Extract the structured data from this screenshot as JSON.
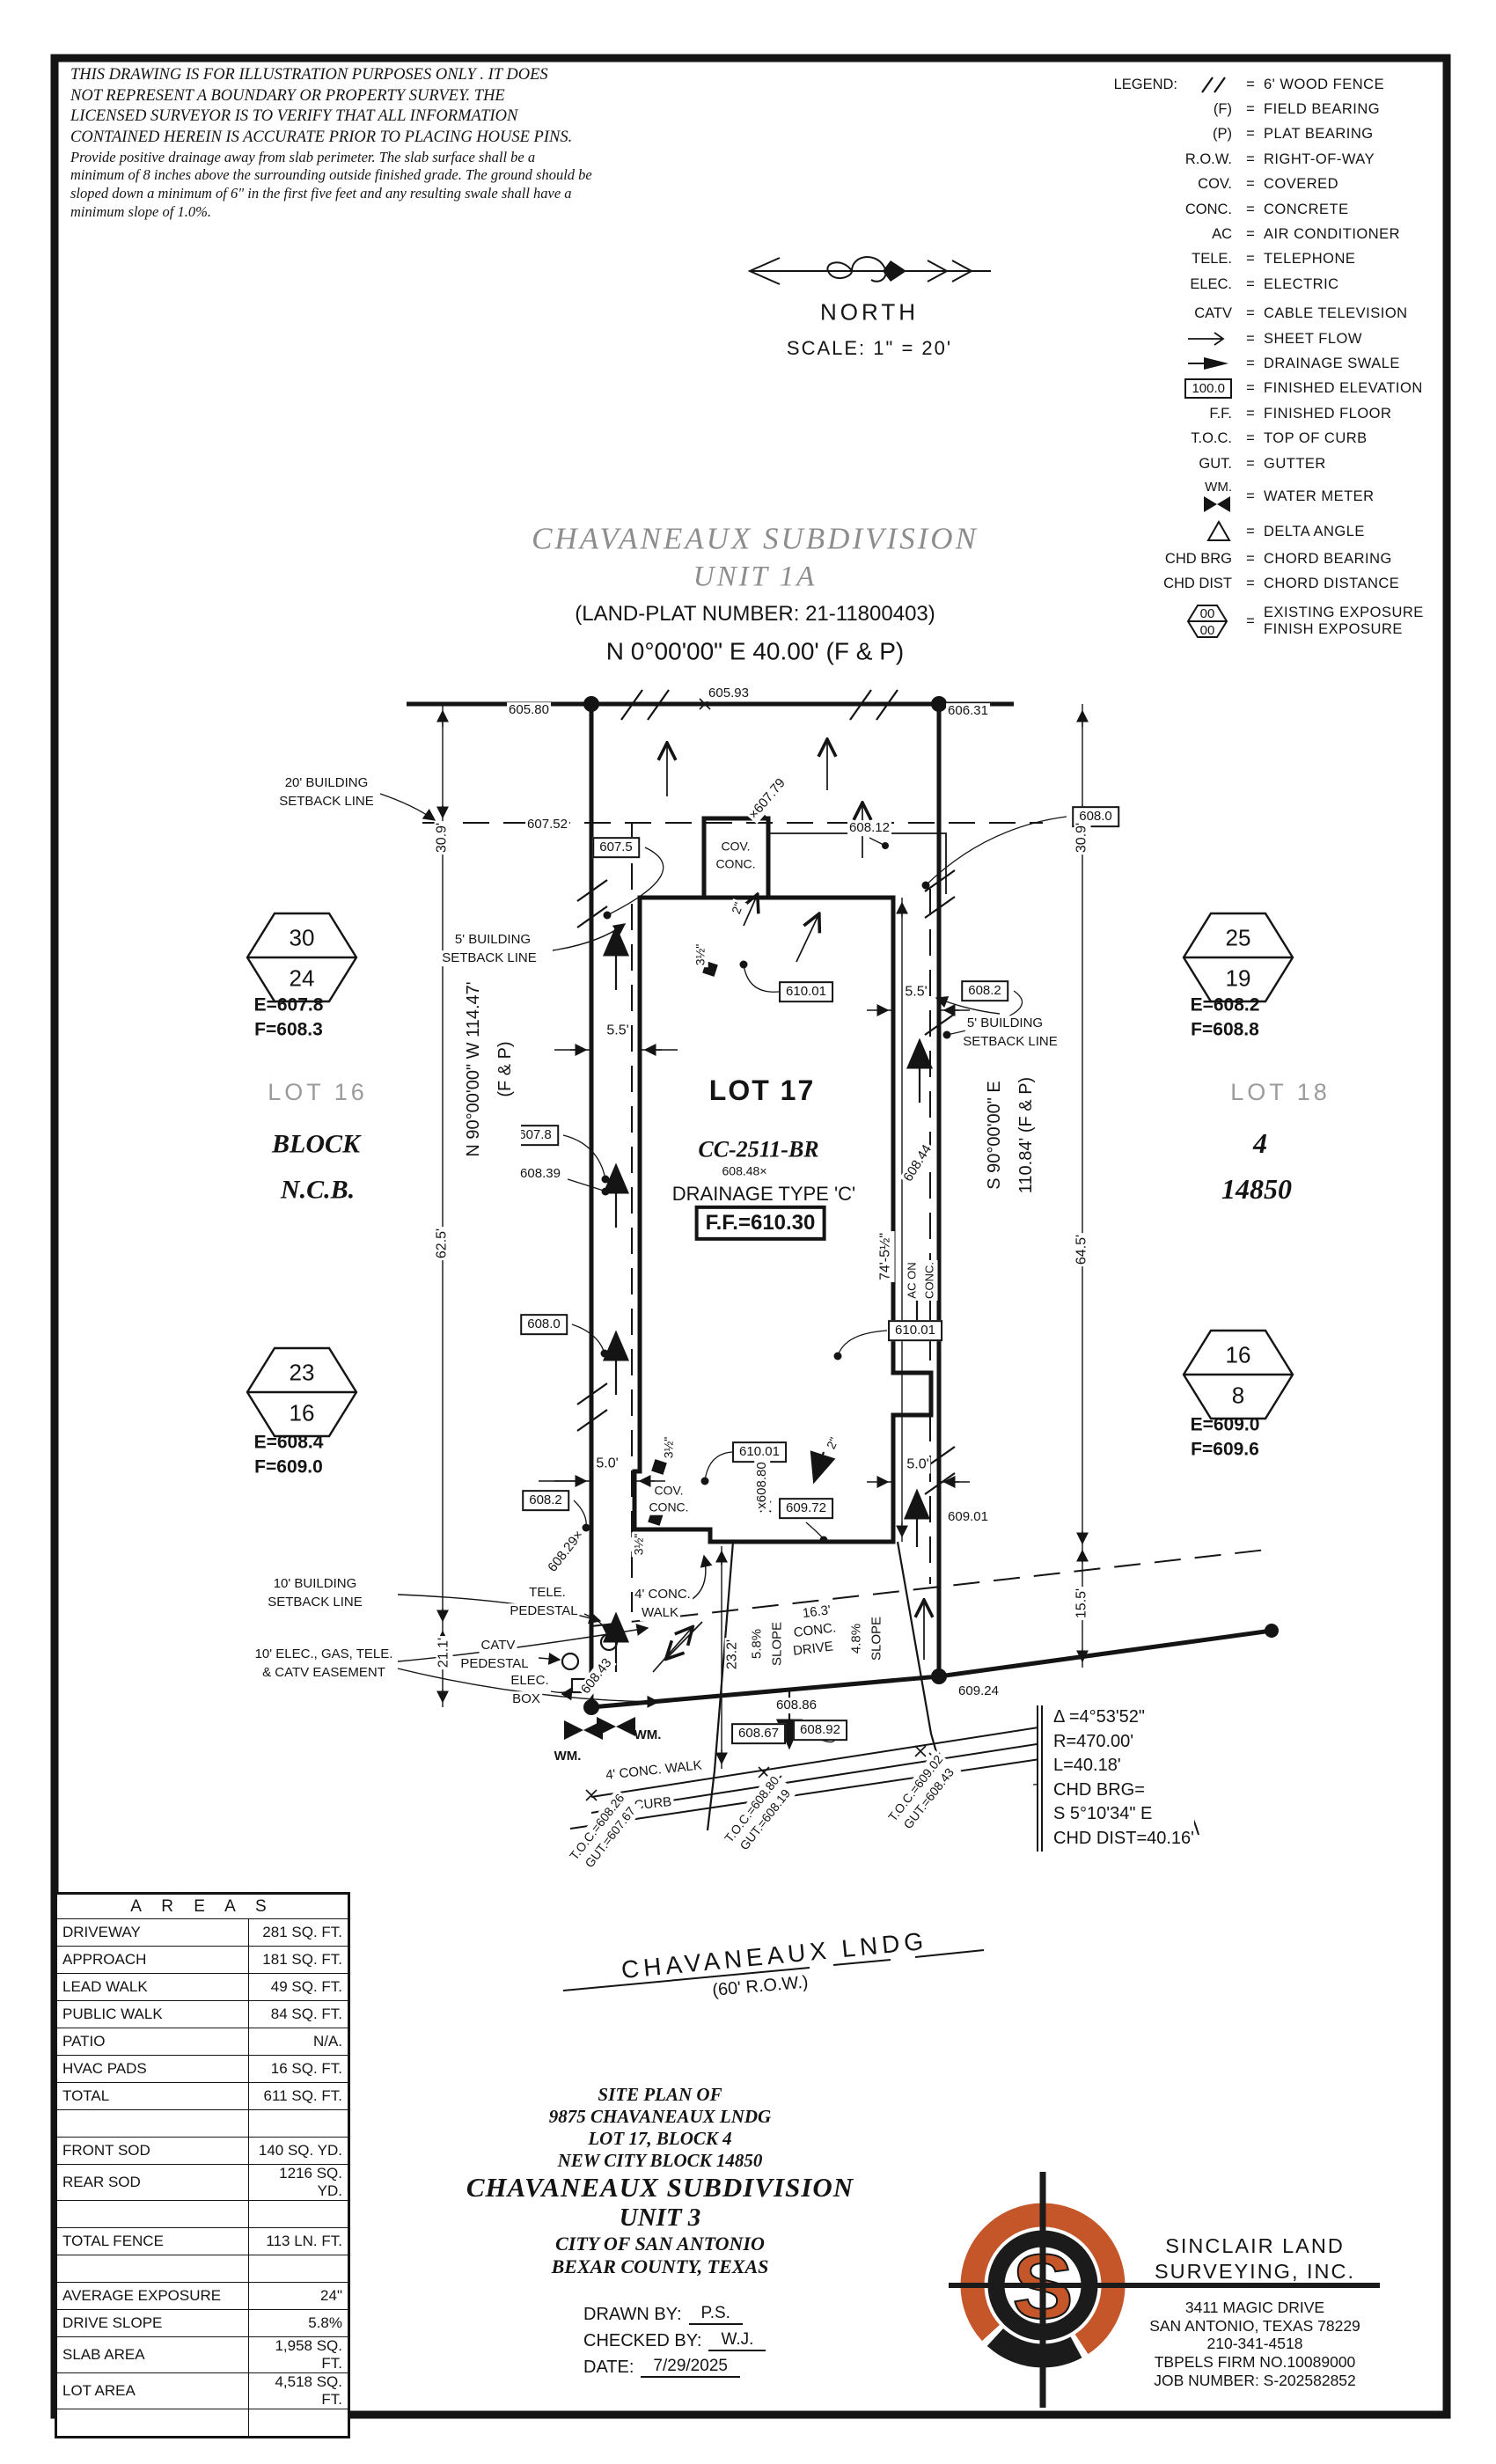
{
  "sheet": {
    "disclaimer_caps": [
      "THIS DRAWING IS FOR ILLUSTRATION PURPOSES ONLY . IT DOES",
      "NOT REPRESENT A BOUNDARY OR PROPERTY SURVEY. THE",
      "LICENSED SURVEYOR IS TO VERIFY THAT ALL INFORMATION",
      "CONTAINED HEREIN IS ACCURATE PRIOR TO PLACING HOUSE PINS."
    ],
    "disclaimer_note": [
      "Provide positive drainage away from slab perimeter. The slab surface shall be a",
      "minimum of 8 inches above the surrounding outside finished grade. The ground should be",
      "sloped down a minimum of 6\" in the first five feet and any resulting swale shall have a",
      "minimum slope of 1.0%."
    ]
  },
  "north": {
    "label": "NORTH",
    "scale": "SCALE:  1\" =  20'"
  },
  "legend": {
    "title": "LEGEND:",
    "items": [
      {
        "sym": "",
        "desc": "6' WOOD FENCE"
      },
      {
        "sym": "(F)",
        "desc": "FIELD BEARING"
      },
      {
        "sym": "(P)",
        "desc": "PLAT BEARING"
      },
      {
        "sym": "R.O.W.",
        "desc": "RIGHT-OF-WAY"
      },
      {
        "sym": "COV.",
        "desc": "COVERED"
      },
      {
        "sym": "CONC.",
        "desc": "CONCRETE"
      },
      {
        "sym": "AC",
        "desc": "AIR CONDITIONER"
      },
      {
        "sym": "TELE.",
        "desc": "TELEPHONE"
      },
      {
        "sym": "ELEC.",
        "desc": "ELECTRIC"
      },
      {
        "sym": "CATV",
        "desc": "CABLE TELEVISION"
      },
      {
        "sym": "",
        "desc": "SHEET FLOW"
      },
      {
        "sym": "",
        "desc": "DRAINAGE SWALE"
      },
      {
        "sym": "100.0",
        "desc": "FINISHED ELEVATION"
      },
      {
        "sym": "F.F.",
        "desc": "FINISHED FLOOR"
      },
      {
        "sym": "T.O.C.",
        "desc": "TOP OF CURB"
      },
      {
        "sym": "GUT.",
        "desc": "GUTTER"
      },
      {
        "sym": "WM.",
        "desc": "WATER METER"
      },
      {
        "sym": "",
        "desc": "DELTA ANGLE"
      },
      {
        "sym": "CHD BRG",
        "desc": "CHORD BEARING"
      },
      {
        "sym": "CHD DIST",
        "desc": "CHORD DISTANCE"
      },
      {
        "sym": "00",
        "sym2": "00",
        "desc": "EXISTING EXPOSURE",
        "desc2": "FINISH EXPOSURE"
      }
    ]
  },
  "title": {
    "line1": "CHAVANEAUX  SUBDIVISION",
    "line2": "UNIT  1A",
    "plat": "(LAND-PLAT NUMBER:  21-11800403)",
    "bearing_top": "N  0°00'00\"  E  40.00'  (F  &  P)"
  },
  "plan": {
    "elev": {
      "v60580": "605.80",
      "v60593": "605.93",
      "v60631": "606.31",
      "v60752": "607.52",
      "v60812": "608.12",
      "vx60779": "×607.79",
      "v6075": "607.5",
      "v6078": "607.8",
      "v60839": "608.39",
      "v6080": "608.0",
      "v6082": "608.2",
      "v61001": "610.01",
      "v60848": "608.48×",
      "vx60880": "x608.80",
      "v60972": "609.72",
      "v60829": "608.29×",
      "v60843": "608.43",
      "v60844": "608.44",
      "v60901": "609.01",
      "v60924": "609.24",
      "v60886": "608.86",
      "v60867": "608.67",
      "v60892": "608.92"
    },
    "dims": {
      "d309": "30.9'",
      "d625": "62.5'",
      "d211": "21.1'",
      "d645": "64.5'",
      "d155": "15.5'",
      "d232": "23.2'",
      "d745": "74'-5½\"",
      "d55": "5.5'",
      "d50": "5.0'",
      "d2": "2\"",
      "d35": "3½\""
    },
    "setbacks": {
      "s20a": "20' BUILDING",
      "s20b": "SETBACK LINE",
      "s5a": "5' BUILDING",
      "s5b": "SETBACK LINE",
      "s10a": "10' BUILDING",
      "s10b": "SETBACK LINE",
      "easeA": "10' ELEC., GAS, TELE.",
      "easeB": "& CATV EASEMENT"
    },
    "features": {
      "tele": "TELE.",
      "pedestal": "PEDESTAL",
      "catv": "CATV",
      "elec": "ELEC.",
      "box": "BOX",
      "wm": "WM.",
      "covA": "COV.",
      "covB": "CONC.",
      "acA": "AC ON",
      "acB": "CONC.",
      "walkA": "4' CONC.",
      "walkB": "WALK",
      "walk2": "4' CONC. WALK",
      "curb": "CURB",
      "slope1": "5.8%",
      "slope2": "4.8%",
      "slopeTxt": "SLOPE",
      "drive1": "16.3'",
      "drive2": "CONC.",
      "drive3": "DRIVE"
    },
    "toc": {
      "t1a": "T.O.C.=608.26",
      "t1b": "GUT.=607.67",
      "t2a": "T.O.C.=608.80",
      "t2b": "GUT.=608.19",
      "t3a": "T.O.C.=609.02",
      "t3b": "GUT.=608.43"
    },
    "lots": {
      "lot16": "LOT 16",
      "block": "BLOCK",
      "ncb": "N.C.B.",
      "lot17": "LOT 17",
      "model": "CC-2511-BR",
      "drainage": "DRAINAGE TYPE 'C'",
      "ff": "F.F.=610.30",
      "lot18": "LOT 18",
      "blk4": "4",
      "ncb14850": "14850"
    },
    "bearings": {
      "west1": "N 90°00'00\" W 114.47'",
      "west2": "(F & P)",
      "east1": "S 90°00'00\" E",
      "east2": "110.84' (F & P)"
    },
    "hex": {
      "h1t": "30",
      "h1b": "24",
      "h1e": "E=607.8",
      "h1f": "F=608.3",
      "h2t": "25",
      "h2b": "19",
      "h2e": "E=608.2",
      "h2f": "F=608.8",
      "h3t": "23",
      "h3b": "16",
      "h3e": "E=608.4",
      "h3f": "F=609.0",
      "h4t": "16",
      "h4b": "8",
      "h4e": "E=609.0",
      "h4f": "F=609.6"
    }
  },
  "curve": {
    "delta": "Δ =4°53'52\"",
    "r": "R=470.00'",
    "l": "L=40.18'",
    "chd1": "CHD  BRG=",
    "chd2": "S  5°10'34\"  E",
    "chd3": "CHD  DIST=40.16'"
  },
  "street": {
    "name": "CHAVANEAUX  LNDG",
    "row": "(60'  R.O.W.)"
  },
  "areas": {
    "title": "A R E A S",
    "rows": [
      {
        "label": "DRIVEWAY",
        "value": "281 SQ. FT."
      },
      {
        "label": "APPROACH",
        "value": "181 SQ. FT."
      },
      {
        "label": "LEAD WALK",
        "value": "49 SQ. FT."
      },
      {
        "label": "PUBLIC WALK",
        "value": "84 SQ. FT."
      },
      {
        "label": "PATIO",
        "value": "N/A."
      },
      {
        "label": "HVAC PADS",
        "value": "16 SQ. FT."
      },
      {
        "label": "TOTAL",
        "value": "611 SQ. FT."
      },
      {
        "label": "",
        "value": ""
      },
      {
        "label": "FRONT SOD",
        "value": "140 SQ. YD."
      },
      {
        "label": "REAR SOD",
        "value": "1216 SQ. YD."
      },
      {
        "label": "",
        "value": ""
      },
      {
        "label": "TOTAL FENCE",
        "value": "113 LN. FT."
      },
      {
        "label": "",
        "value": ""
      },
      {
        "label": "AVERAGE EXPOSURE",
        "value": "24\""
      },
      {
        "label": "DRIVE SLOPE",
        "value": "5.8%"
      },
      {
        "label": "SLAB AREA",
        "value": "1,958 SQ. FT."
      },
      {
        "label": "LOT AREA",
        "value": "4,518 SQ. FT."
      },
      {
        "label": "",
        "value": ""
      }
    ]
  },
  "siteplan": {
    "lines": [
      "SITE  PLAN  OF",
      "9875  CHAVANEAUX  LNDG",
      "LOT  17,  BLOCK  4",
      "NEW  CITY  BLOCK  14850",
      "CHAVANEAUX  SUBDIVISION",
      "UNIT  3",
      "CITY  OF  SAN  ANTONIO",
      "BEXAR  COUNTY,  TEXAS"
    ],
    "drawn_label": "DRAWN  BY:",
    "drawn": "P.S.",
    "checked_label": "CHECKED  BY:",
    "checked": "W.J.",
    "date_label": "DATE:",
    "date": "7/29/2025"
  },
  "firm": {
    "name1": "SINCLAIR  LAND",
    "name2": "SURVEYING,  INC.",
    "addr1": "3411  MAGIC  DRIVE",
    "addr2": "SAN  ANTONIO,  TEXAS  78229",
    "phone": "210-341-4518",
    "firm_no": "TBPELS  FIRM  NO.10089000",
    "job": "JOB  NUMBER:  S-202582852",
    "monogram": "S",
    "orange": "#c4562a"
  }
}
